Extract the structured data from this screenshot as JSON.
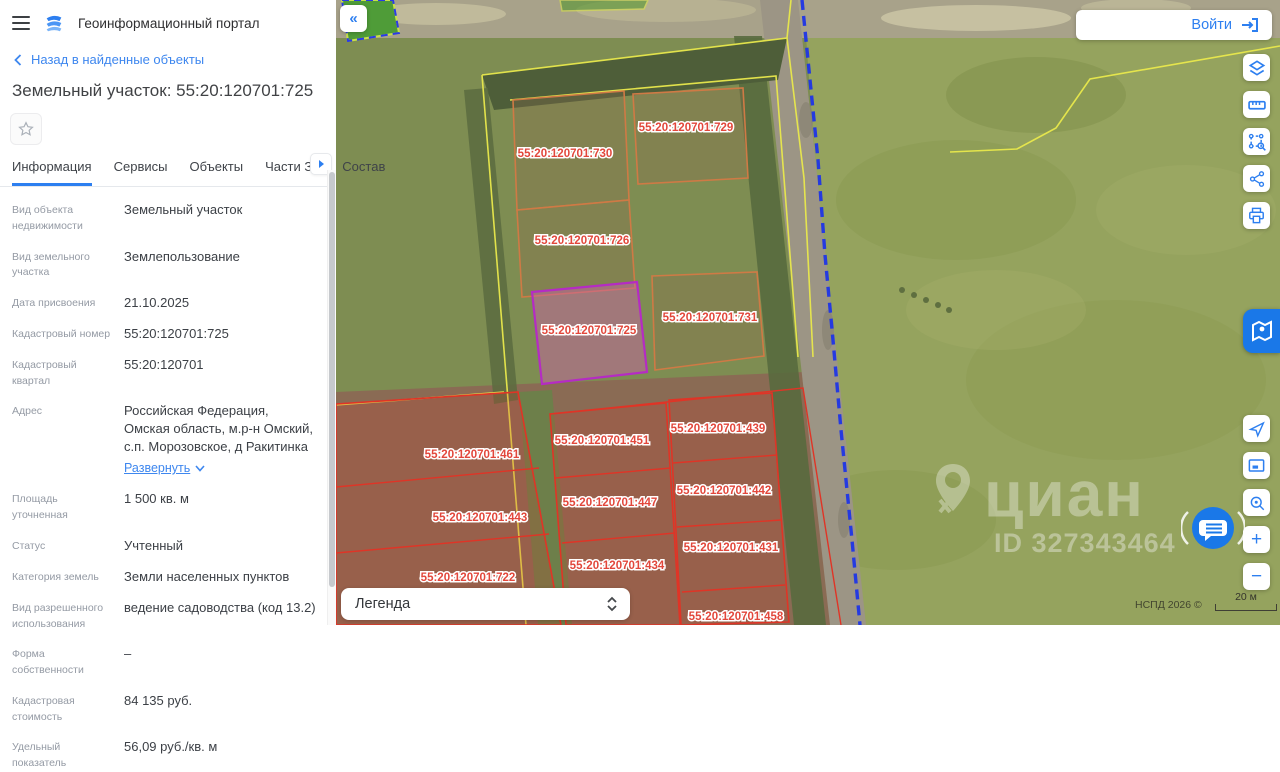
{
  "header": {
    "title": "Геоинформационный портал"
  },
  "login": {
    "label": "Войти"
  },
  "panel": {
    "back_link": "Назад в найденные объекты",
    "title": "Земельный участок: 55:20:120701:725",
    "tabs": [
      {
        "label": "Информация",
        "active": true
      },
      {
        "label": "Сервисы",
        "active": false
      },
      {
        "label": "Объекты",
        "active": false
      },
      {
        "label": "Части ЗУ",
        "active": false
      },
      {
        "label": "Состав",
        "active": false
      }
    ],
    "fields": [
      {
        "label": "Вид объекта недвижимости",
        "value": "Земельный участок"
      },
      {
        "label": "Вид земельного участка",
        "value": "Землепользование"
      },
      {
        "label": "Дата присвоения",
        "value": "21.10.2025"
      },
      {
        "label": "Кадастровый номер",
        "value": "55:20:120701:725"
      },
      {
        "label": "Кадастровый квартал",
        "value": "55:20:120701"
      },
      {
        "label": "Адрес",
        "value": "Российская Федерация, Омская область, м.р-н Омский, с.п. Морозовское, д Ракитинка",
        "expand_label": "Развернуть"
      },
      {
        "label": "Площадь уточненная",
        "value": "1 500 кв. м"
      },
      {
        "label": "Статус",
        "value": "Учтенный"
      },
      {
        "label": "Категория земель",
        "value": "Земли населенных пунктов"
      },
      {
        "label": "Вид разрешенного использования",
        "value": "ведение садоводства (код 13.2)"
      },
      {
        "label": "Форма собственности",
        "value": "–"
      },
      {
        "label": "Кадастровая стоимость",
        "value": "84 135 руб."
      },
      {
        "label": "Удельный показатель",
        "value": "56,09 руб./кв. м"
      }
    ]
  },
  "map": {
    "selected_parcel": "55:20:120701:725",
    "parcel_labels": [
      {
        "text": "55:20:120701:730",
        "x": 229,
        "y": 157
      },
      {
        "text": "55:20:120701:729",
        "x": 350,
        "y": 131
      },
      {
        "text": "55:20:120701:726",
        "x": 246,
        "y": 244
      },
      {
        "text": "55:20:120701:725",
        "x": 253,
        "y": 334,
        "selected": true
      },
      {
        "text": "55:20:120701:731",
        "x": 374,
        "y": 321
      },
      {
        "text": "55:20:120701:461",
        "x": 136,
        "y": 458
      },
      {
        "text": "55:20:120701:451",
        "x": 266,
        "y": 444
      },
      {
        "text": "55:20:120701:439",
        "x": 382,
        "y": 432
      },
      {
        "text": "55:20:120701:447",
        "x": 274,
        "y": 506
      },
      {
        "text": "55:20:120701:442",
        "x": 388,
        "y": 494
      },
      {
        "text": "55:20:120701:443",
        "x": 144,
        "y": 521
      },
      {
        "text": "55:20:120701:434",
        "x": 281,
        "y": 569
      },
      {
        "text": "55:20:120701:431",
        "x": 395,
        "y": 551
      },
      {
        "text": "55:20:120701:722",
        "x": 132,
        "y": 581
      },
      {
        "text": "55:20:120701:458",
        "x": 400,
        "y": 620
      }
    ],
    "legend_label": "Легенда",
    "watermark": {
      "brand": "циан",
      "id_text": "ID 327343464"
    },
    "attribution": "НСПД 2026 ©",
    "scale_text": "20 м"
  },
  "colors": {
    "accent": "#2d7ff0",
    "selected_parcel_stroke": "#b52bc4",
    "parcel_label": "#e2473b",
    "parcel_stroke": "#cf7a45",
    "red_block_stroke": "#e03426",
    "quarter_boundary": "#e9e94c",
    "municipal_boundary": "#1f35e6",
    "nspd_blue": "#1a78e8"
  }
}
